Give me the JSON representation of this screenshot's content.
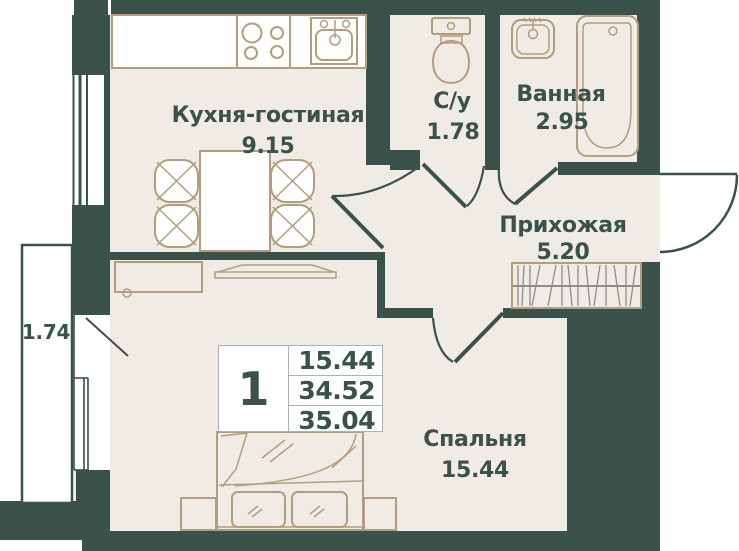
{
  "rooms": {
    "kitchen_living": {
      "label": "Кухня-гостиная",
      "area": "9.15"
    },
    "wc": {
      "label": "С/у",
      "area": "1.78"
    },
    "bathroom": {
      "label": "Ванная",
      "area": "2.95"
    },
    "hallway": {
      "label": "Прихожая",
      "area": "5.20"
    },
    "bedroom": {
      "label": "Спальня",
      "area": "15.44"
    },
    "balcony": {
      "area": "1.74"
    }
  },
  "summary": {
    "rooms_count": "1",
    "living_area": "15.44",
    "area_without_balcony": "34.52",
    "total_area": "35.04"
  },
  "fixtures": [
    "stove-icon",
    "kitchen-sink-icon",
    "dining-table-icon",
    "chair-icon",
    "toilet-icon",
    "washbasin-icon",
    "bathtub-icon",
    "tv-icon",
    "tv-cabinet-icon",
    "wardrobe-icon",
    "double-bed-icon",
    "pillow-icon",
    "nightstand-icon",
    "door-swing-icon",
    "window-icon",
    "balcony-icon"
  ],
  "colors": {
    "wall": "#3a524a",
    "floor": "#f0ebe5",
    "fur": "#b29e7e",
    "hatch": "#8d8d8d",
    "tbl": "#a9b4ad",
    "paper": "#ffffff"
  }
}
